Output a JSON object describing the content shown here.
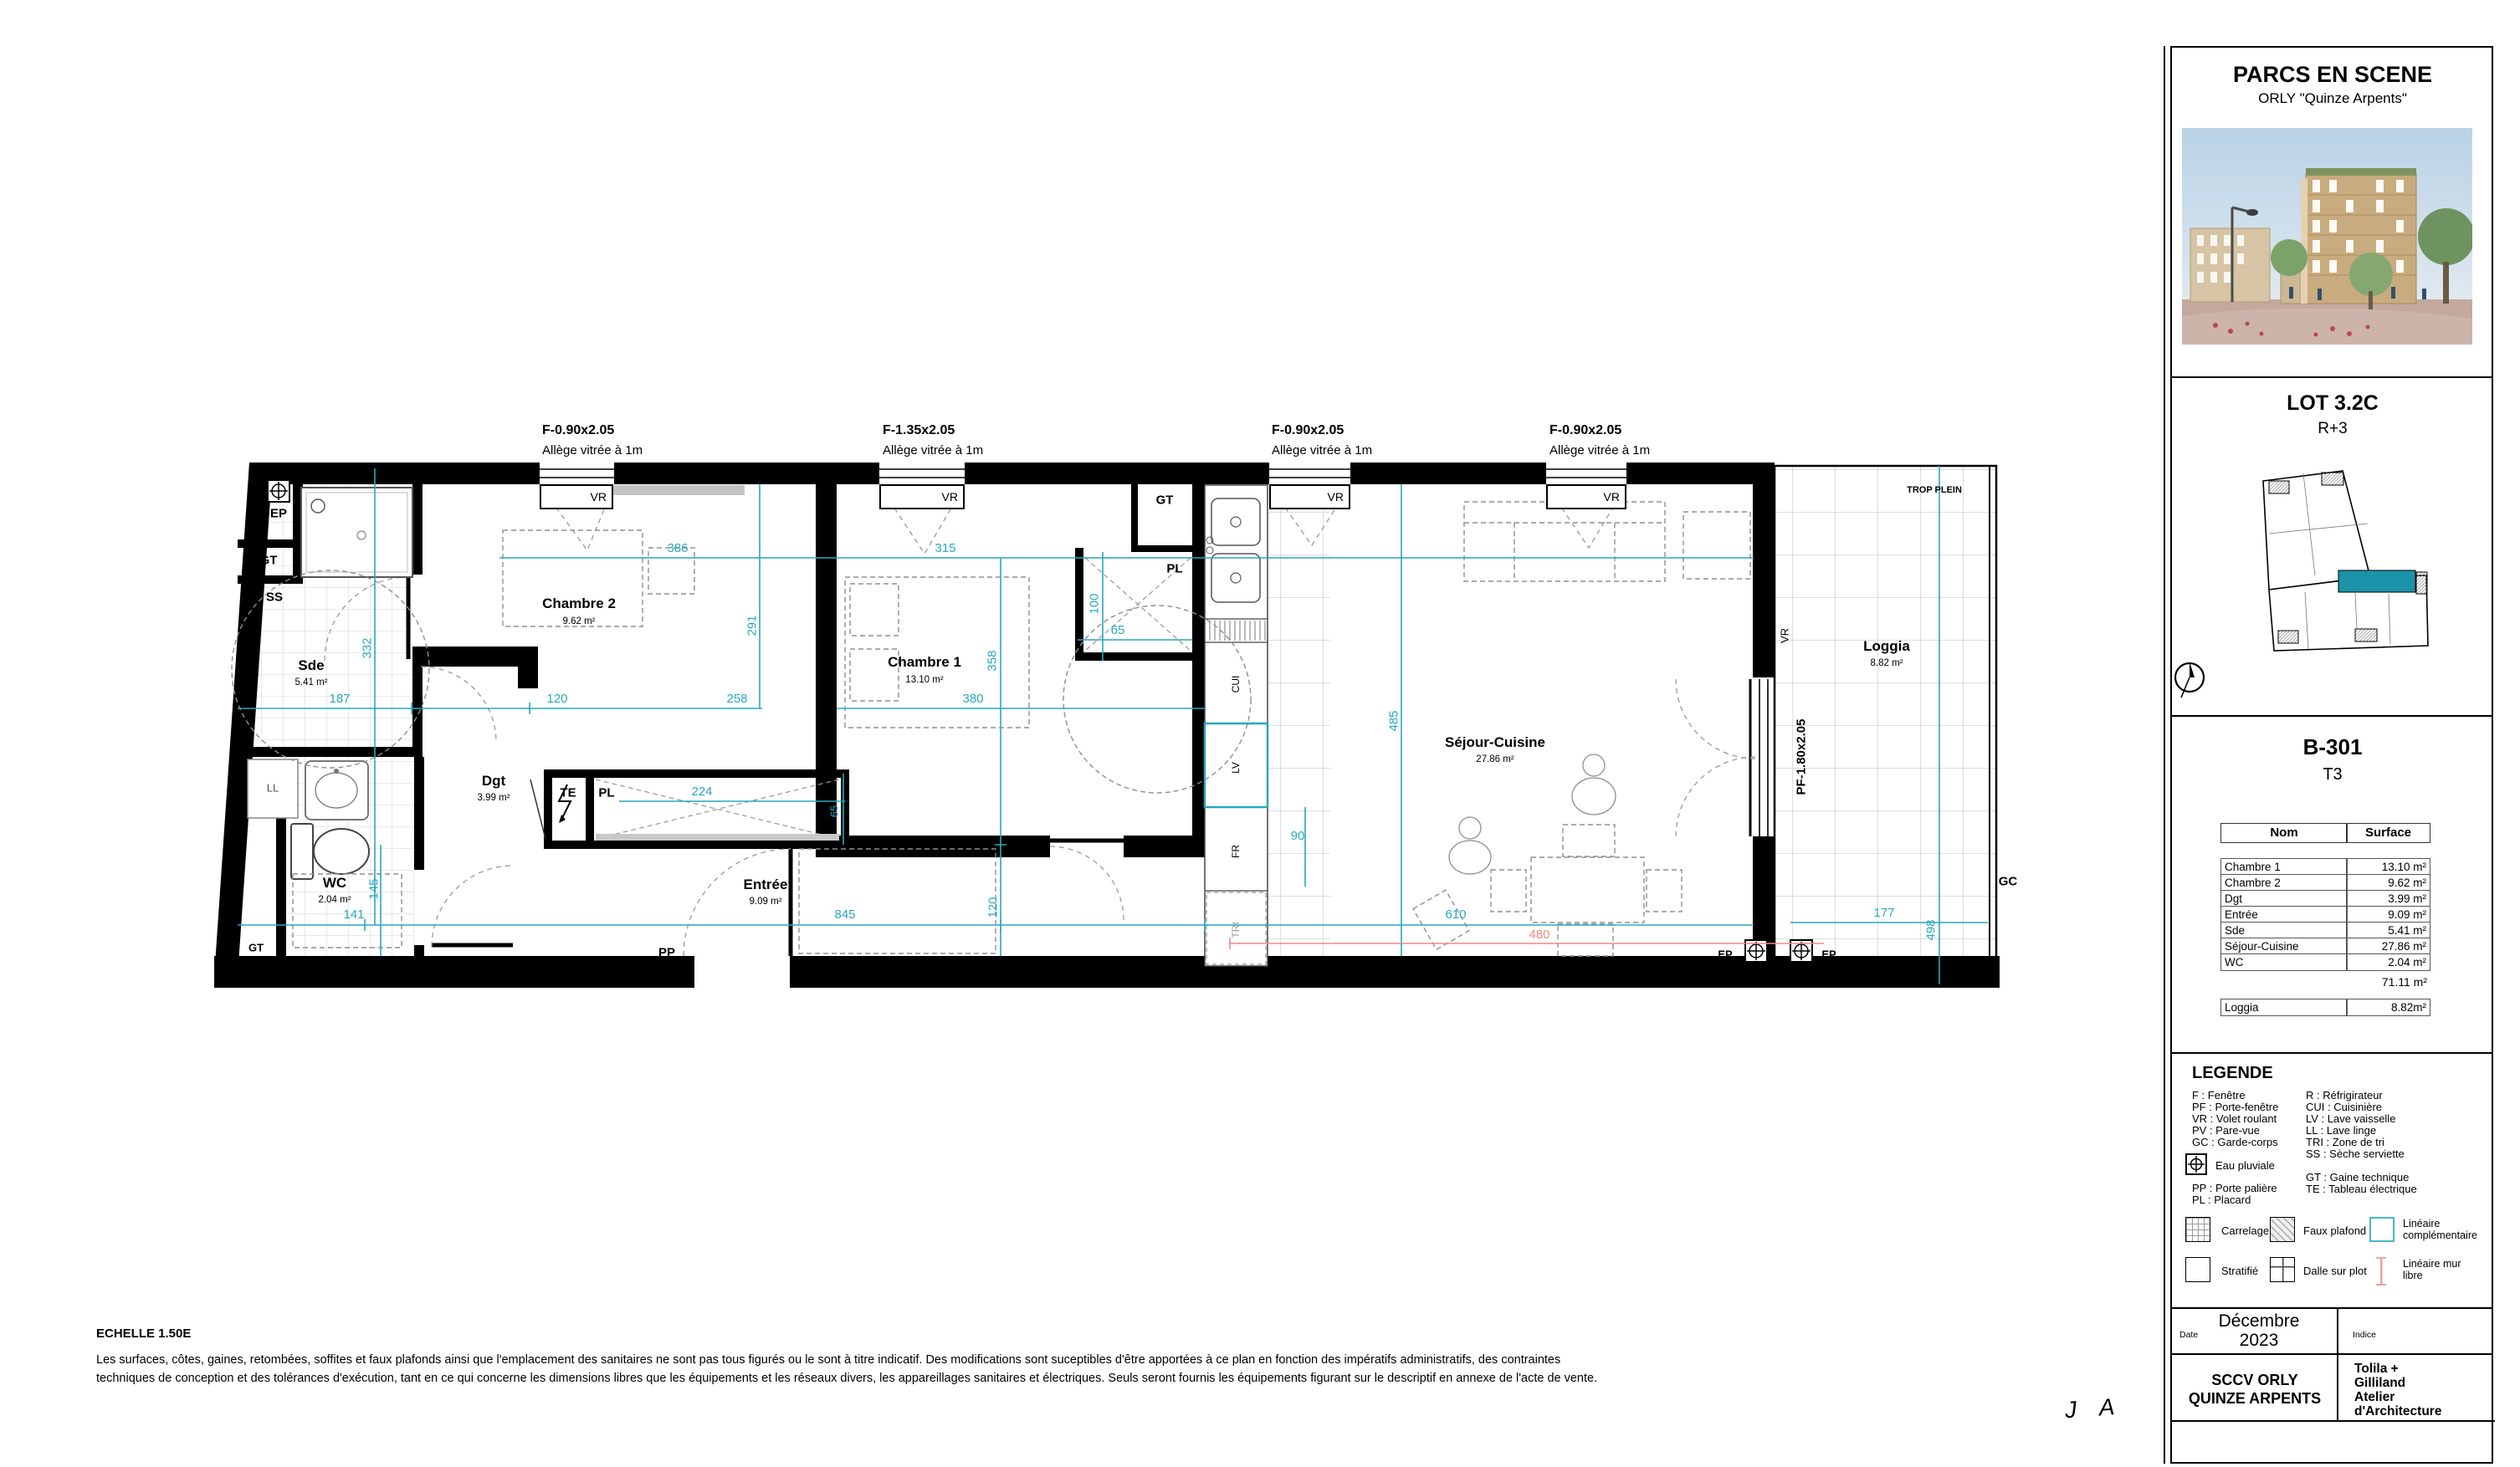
{
  "panel": {
    "project": {
      "title": "PARCS EN SCENE",
      "subtitle": "ORLY \"Quinze Arpents\""
    },
    "lot": {
      "title": "LOT 3.2C",
      "level": "R+3"
    },
    "unit": {
      "code": "B-301",
      "type": "T3"
    },
    "table": {
      "headers": {
        "name": "Nom",
        "surface": "Surface"
      },
      "rows": [
        {
          "name": "Chambre 1",
          "surface": "13.10 m²"
        },
        {
          "name": "Chambre 2",
          "surface": "9.62 m²"
        },
        {
          "name": "Dgt",
          "surface": "3.99 m²"
        },
        {
          "name": "Entrée",
          "surface": "9.09 m²"
        },
        {
          "name": "Sde",
          "surface": "5.41 m²"
        },
        {
          "name": "Séjour-Cuisine",
          "surface": "27.86 m²"
        },
        {
          "name": "WC",
          "surface": "2.04 m²"
        }
      ],
      "total": "71.11 m²",
      "loggia": {
        "name": "Loggia",
        "surface": "8.82m²"
      }
    },
    "legend": {
      "title": "LEGENDE",
      "col1": [
        "F : Fenêtre",
        "PF : Porte-fenêtre",
        "VR : Volet roulant",
        "PV : Pare-vue",
        "GC : Garde-corps"
      ],
      "eau_pluviale": "Eau pluviale",
      "col1b": [
        "PP : Porte palière",
        "PL : Placard"
      ],
      "col2": [
        "R : Réfrigirateur",
        "CUI : Cuisinière",
        "LV : Lave vaisselle",
        "LL : Lave linge",
        "TRI : Zone de tri",
        "SS : Sèche serviette"
      ],
      "col2b": [
        "GT : Gaine technique",
        "TE : Tableau électrique"
      ],
      "swatches": {
        "carrelage": "Carrelage",
        "faux_plafond": "Faux plafond",
        "lineaire_complementaire_1": "Linéaire",
        "lineaire_complementaire_2": "complémentaire",
        "stratifie": "Stratifié",
        "dalle_sur_plot": "Dalle sur plot",
        "lineaire_mur_libre_1": "Linéaire mur",
        "lineaire_mur_libre_2": "libre"
      }
    },
    "footer": {
      "date_label": "Date",
      "date_value": "Décembre 2023",
      "indice_label": "Indice",
      "owner_line1": "SCCV ORLY",
      "owner_line2": "QUINZE ARPENTS",
      "architect": [
        "Tolila +",
        "Gilliland",
        "Atelier",
        "d'Architecture"
      ]
    }
  },
  "plan": {
    "windows": [
      {
        "spec": "F-0.90x2.05",
        "note": "Allège vitrée à 1m",
        "shutter": "VR"
      },
      {
        "spec": "F-1.35x2.05",
        "note": "Allège vitrée à 1m",
        "shutter": "VR"
      },
      {
        "spec": "F-0.90x2.05",
        "note": "Allège vitrée à 1m",
        "shutter": "VR"
      },
      {
        "spec": "F-0.90x2.05",
        "note": "Allège vitrée à 1m",
        "shutter": "VR"
      }
    ],
    "bay": {
      "spec": "PF-1.80x2.05",
      "shutter": "VR"
    },
    "rooms": {
      "sde": {
        "name": "Sde",
        "area": "5.41 m²"
      },
      "chambre2": {
        "name": "Chambre 2",
        "area": "9.62 m²"
      },
      "chambre1": {
        "name": "Chambre 1",
        "area": "13.10 m²"
      },
      "dgt": {
        "name": "Dgt",
        "area": "3.99 m²"
      },
      "wc": {
        "name": "WC",
        "area": "2.04 m²"
      },
      "entree": {
        "name": "Entrée",
        "area": "9.09 m²"
      },
      "sejour": {
        "name": "Séjour-Cuisine",
        "area": "27.86 m²"
      },
      "loggia": {
        "name": "Loggia",
        "area": "8.82 m²"
      }
    },
    "markers": {
      "ep": "EP",
      "gt": "GT",
      "ss": "SS",
      "ll": "LL",
      "te": "TE",
      "pl": "PL",
      "pp": "PP",
      "vr": "VR",
      "gc": "GC",
      "cui": "CUI",
      "lv": "LV",
      "fr": "FR",
      "tri": "TRI",
      "trop_plein": "TROP PLEIN"
    },
    "dims": {
      "d386": "386",
      "d315": "315",
      "d291": "291",
      "d332": "332",
      "d187": "187",
      "d120a": "120",
      "d258": "258",
      "d224": "224",
      "d65a": "65",
      "d100": "100",
      "d65b": "65",
      "d358": "358",
      "d380": "380",
      "d145": "145",
      "d141": "141",
      "d845": "845",
      "d120b": "120",
      "d90": "90",
      "d485": "485",
      "d610": "610",
      "d498": "498",
      "d177": "177",
      "d480": "480"
    }
  },
  "notes": {
    "scale": "ECHELLE 1.50E",
    "disclaimer1": "Les surfaces, côtes, gaines, retombées, soffites et faux plafonds ainsi que l'emplacement des sanitaires ne sont pas tous figurés ou le sont à titre indicatif. Des modifications sont suceptibles d'être apportées à ce plan en fonction des impératifs administratifs, des contraintes",
    "disclaimer2": "techniques de conception et des tolérances d'exécution, tant en ce qui concerne les dimensions libres que les équipements et les réseaux divers, les appareillages sanitaires et électriques. Seuls seront fournis les équipements figurant sur le descriptif en annexe de l'acte de vente.",
    "signature": "J A"
  },
  "colors": {
    "dim_teal": "#2AA7C0",
    "highlight_teal": "#1A93A8",
    "dim_red": "#EF8B80",
    "wall": "#000000"
  }
}
